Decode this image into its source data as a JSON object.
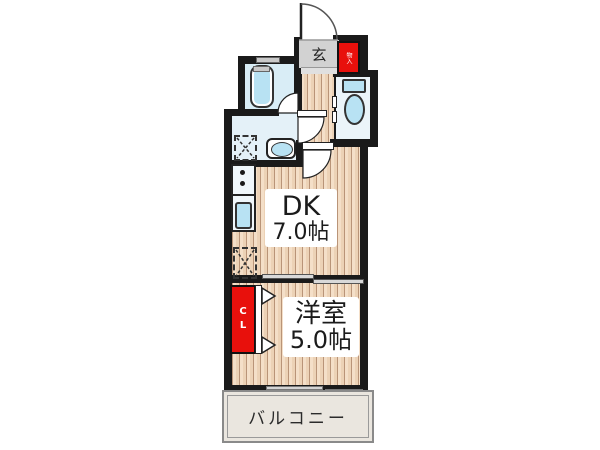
{
  "floorplan": {
    "labels": {
      "entrance": "玄",
      "storage": "物入",
      "dk_name": "DK",
      "dk_size": "7.0帖",
      "bedroom_name": "洋室",
      "bedroom_size": "5.0帖",
      "closet": "CL",
      "balcony": "バルコニー"
    },
    "colors": {
      "wall": "#1a1a1a",
      "accent_red": "#e8100c",
      "fixture_blue": "#b8e2f3",
      "wood_light": "#f4dfc8",
      "wood_dark": "#ecd2b6",
      "wood_line": "#b99478",
      "genkan_gray": "#d2d2d2",
      "bath_fill": "#d9edf6",
      "washroom_fill": "#e4f1f8",
      "toilet_fill": "#ebf4f9",
      "balcony_fill": "#eae6df"
    }
  }
}
